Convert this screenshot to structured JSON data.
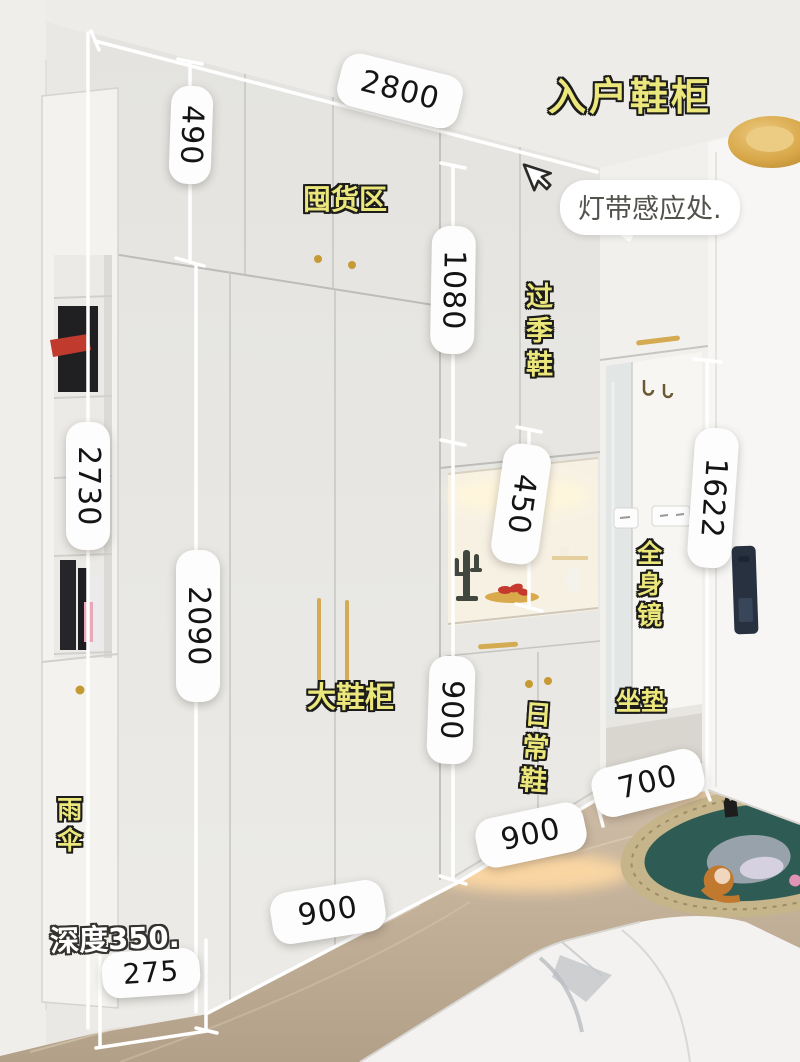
{
  "title": "入户鞋柜",
  "annotations": {
    "stock_area": "囤货区",
    "light_strip_sensor": "灯带感应处.",
    "off_season_shoes": "过季鞋",
    "full_body_mirror": "全身镜",
    "big_shoe_cabinet": "大鞋柜",
    "daily_shoes": "日常鞋",
    "seat_cushion": "坐垫",
    "umbrella": "雨伞",
    "depth_note": "深度350."
  },
  "dimensions": {
    "total_width": "2800",
    "top_section_height": "490",
    "total_height": "2730",
    "tall_door_height": "2090",
    "mid_upper_height": "1080",
    "niche_height": "450",
    "mid_lower_height": "900",
    "hanging_area_height": "1622",
    "bench_width": "700",
    "mid_section_width": "900",
    "base_section_width": "900",
    "side_column_width": "275"
  },
  "colors": {
    "label_yellow": "#ece77c",
    "pill_white": "#fdfdfd",
    "pill_text": "#141414",
    "handle_gold": "#c79a35",
    "lock_navy": "#273140",
    "floor_beige": "#c6b49e",
    "rug_teal": "#2f5b55",
    "led_warm": "#ffd9a3"
  }
}
